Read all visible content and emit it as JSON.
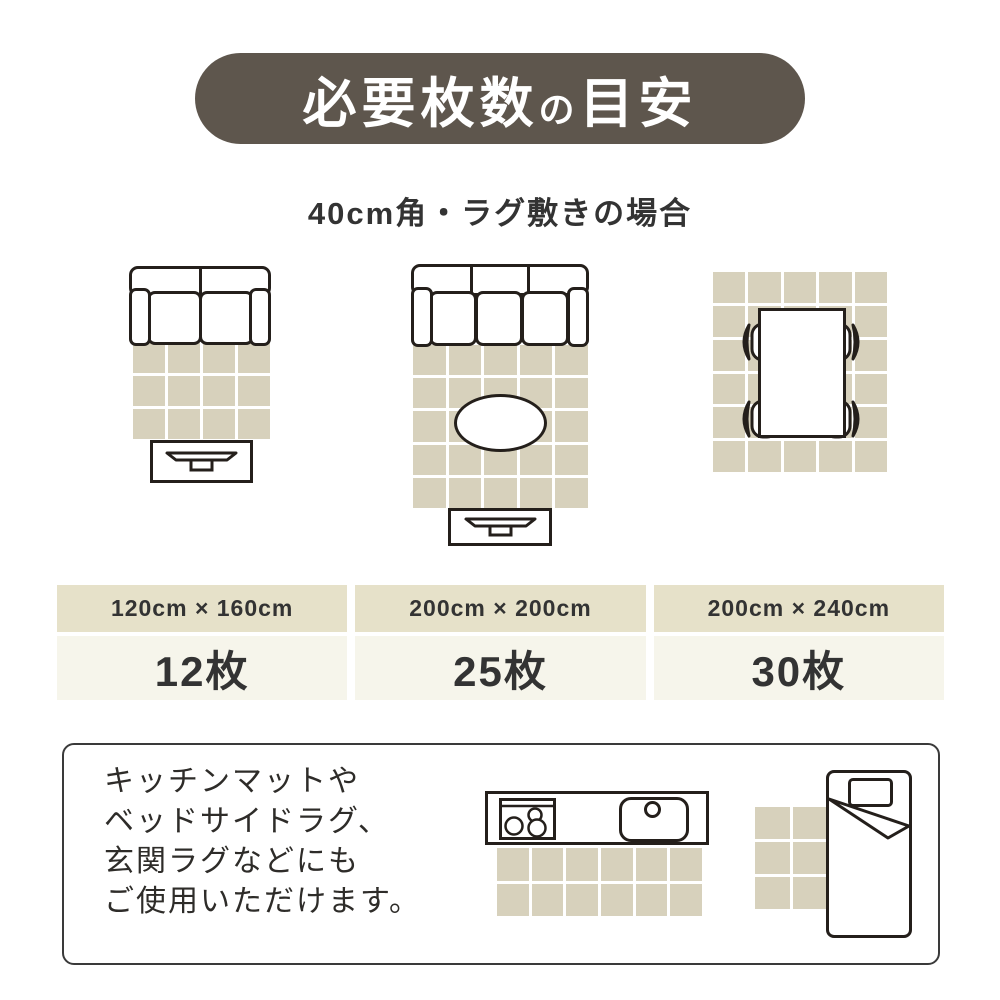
{
  "header": {
    "title_main": "必要枚数",
    "title_particle": "の",
    "title_tail": "目安"
  },
  "subtitle": "40cm角・ラグ敷きの場合",
  "colors": {
    "header_bg": "#5e564d",
    "tile": "#d7d1bc",
    "table_header_bg": "#e6e1c9",
    "table_value_bg": "#f6f5eb",
    "outline": "#241f1b",
    "text": "#333333"
  },
  "layouts": [
    {
      "scene": "two-seat-sofa-rug-tv-board",
      "rug_cols": 4,
      "rug_rows": 3,
      "size": "120cm × 160cm",
      "count": "12枚"
    },
    {
      "scene": "three-seat-sofa-rug-oval-table-tv-board",
      "rug_cols": 5,
      "rug_rows": 5,
      "size": "200cm × 200cm",
      "count": "25枚"
    },
    {
      "scene": "dining-table-four-chairs-rug",
      "rug_cols": 5,
      "rug_rows": 6,
      "size": "200cm × 240cm",
      "count": "30枚"
    }
  ],
  "note": {
    "lines": [
      "キッチンマットや",
      "ベッドサイドラグ、",
      "玄関ラグなどにも",
      "ご使用いただけます。"
    ],
    "kitchen_mat": {
      "cols": 6,
      "rows": 2
    },
    "bedside_mat": {
      "cols": 2,
      "rows": 3
    }
  }
}
